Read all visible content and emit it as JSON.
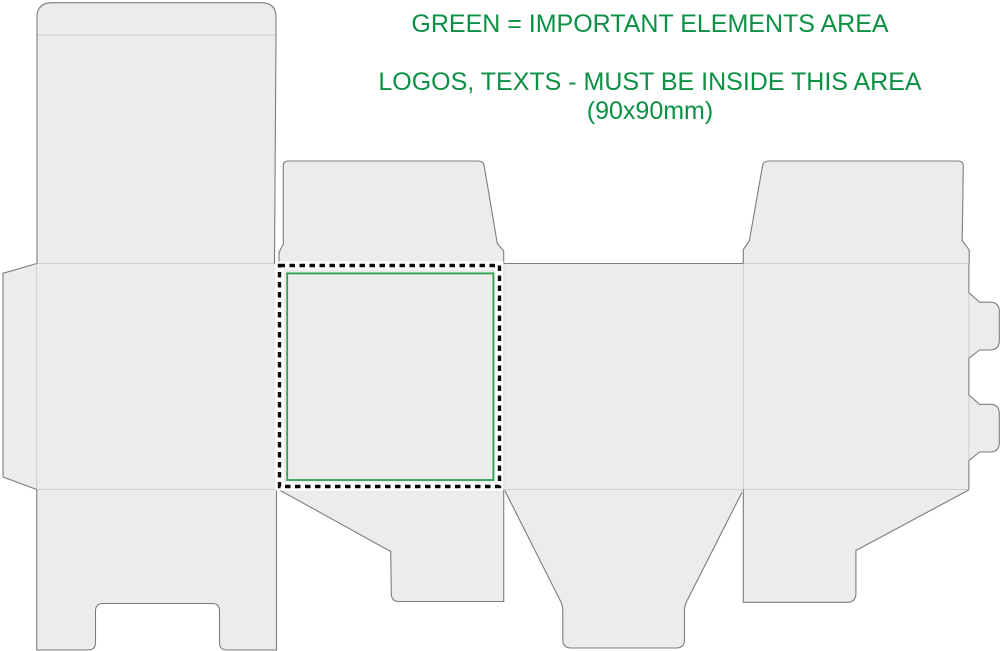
{
  "annotation": {
    "line1": "GREEN = IMPORTANT ELEMENTS AREA",
    "line2": "LOGOS, TEXTS - MUST BE INSIDE THIS AREA",
    "line3": "(90x90mm)"
  },
  "safe_area": {
    "label": "important elements / safe print area",
    "size": "90x90mm"
  },
  "colors": {
    "background": "#ffffff",
    "board_fill": "#ececec",
    "cut_line": "#7d7d7d",
    "crease_line": "#cfcfcf",
    "dash_line": "#0a0a0a",
    "dash_underlay": "#ffffff",
    "safe_area_border": "#2da150",
    "annotation_text": "#0c9044"
  }
}
